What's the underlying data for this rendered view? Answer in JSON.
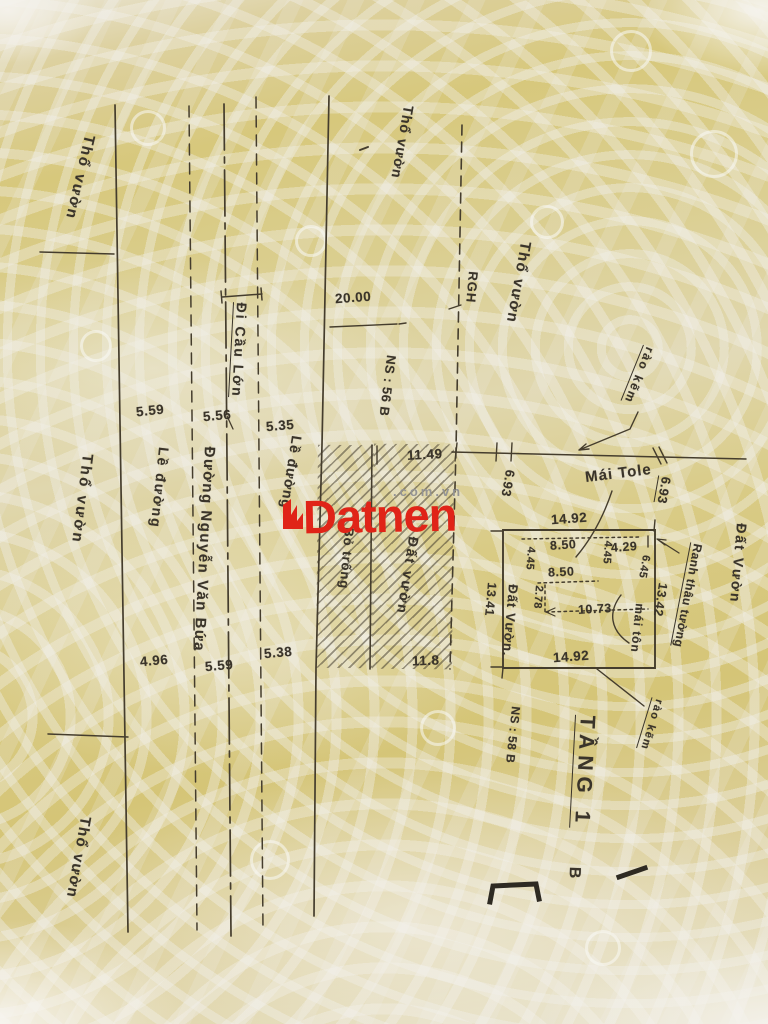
{
  "watermark": {
    "brand": "Datnen",
    "suffix": ".com.vn",
    "brand_color": "#e02418",
    "suffix_color": "#949494"
  },
  "labels": {
    "tho_vuon": "Thổ vườn",
    "di_cau_lon": "Đi Cầu Lớn",
    "rgh": "RGH",
    "ns_56": "NS : 56 B",
    "ns_58": "NS : 58 B",
    "le_duong": "Lề đường",
    "duong_nguyen_van_bua": "Đường Nguyễn Văn Bứa",
    "bo_trong": "Bỏ trống",
    "dat_vuon": "Đất vườn",
    "dat_vuon_cap": "Đất Vườn",
    "dat_vuon_dot": "Đất Vườn.",
    "rao_kem": "rào kẽm",
    "mai_tole": "Mái Tole",
    "mai_ton": "mái tôn",
    "ranh_thau_tuong": "Ranh thâu tường",
    "tang_1": "TẦNG 1",
    "b_fragment": "B"
  },
  "dimensions": {
    "road_width": "20.00",
    "row_upper": [
      "5.59",
      "5.56",
      "5.35"
    ],
    "row_lower": [
      "4.96",
      "5.59",
      "5.38"
    ],
    "hatch_top": "11.49",
    "hatch_bottom": "11.8",
    "offset_left": "6.93",
    "offset_right": "6.93",
    "plot_top": "14.92",
    "plot_bottom": "14.92",
    "plot_left": "13.41",
    "plot_right": "13.42",
    "inner_8_50_a": "8.50",
    "inner_8_50_b": "8.50",
    "inner_4_29": "4.29",
    "inner_4_45_a": "4.45",
    "inner_4_45_b": "4.45",
    "inner_2_78": "2.78",
    "inner_10_73": "10.73",
    "inner_6_45": "6.45"
  }
}
